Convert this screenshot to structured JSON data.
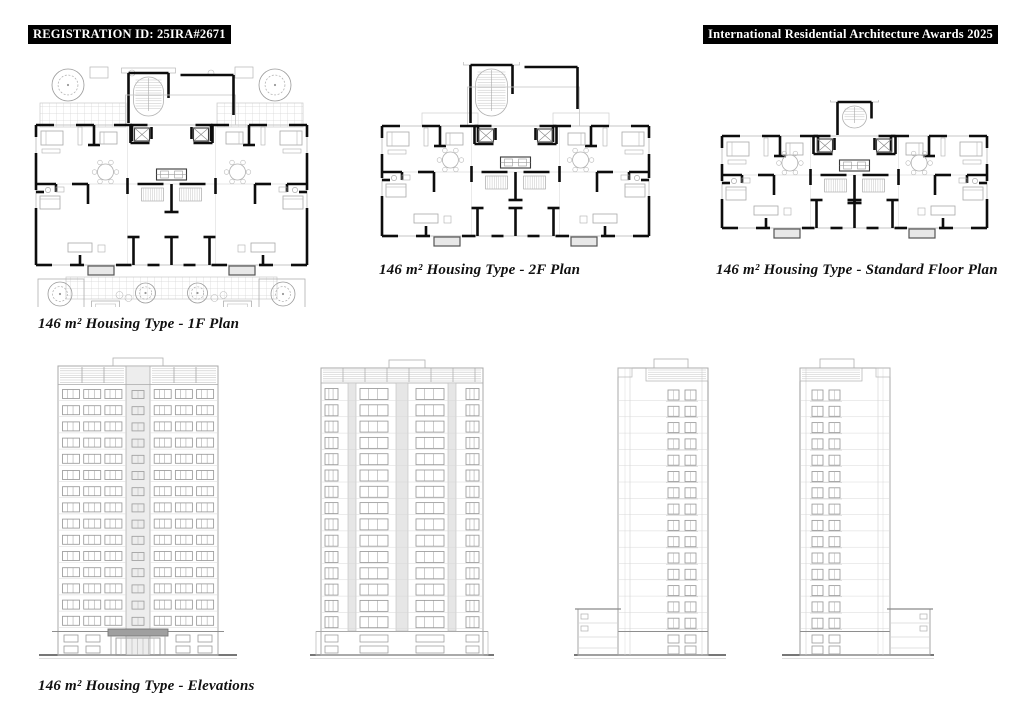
{
  "header": {
    "registration_badge": "REGISTRATION ID: 25IRA#2671",
    "awards_badge": "International Residential Architecture Awards 2025"
  },
  "labels": {
    "plan_1f": "146 m²  Housing Type - 1F Plan",
    "plan_2f": "146 m²  Housing Type - 2F Plan",
    "plan_std": "146 m²  Housing Type - Standard Floor Plan",
    "elevations": "146 m²  Housing Type - Elevations"
  },
  "drawings": {
    "plans": [
      {
        "id": "plan-1f",
        "variant": "1f"
      },
      {
        "id": "plan-2f",
        "variant": "2f"
      },
      {
        "id": "plan-std",
        "variant": "std"
      }
    ],
    "elevations": [
      {
        "id": "elev-front",
        "variant": "front",
        "floors": 15
      },
      {
        "id": "elev-rear",
        "variant": "rear",
        "floors": 15
      },
      {
        "id": "elev-side-left",
        "variant": "side-left",
        "floors": 15
      },
      {
        "id": "elev-side-right",
        "variant": "side-right",
        "floors": 15
      }
    ]
  },
  "colors": {
    "badge_bg": "#000000",
    "badge_text": "#ffffff",
    "label_text": "#111111",
    "wall_black": "#0d0d0d",
    "line_light": "#b3b3b3",
    "line_faint": "#d6d6d6",
    "line_mid": "#9a9a9a",
    "ground_dark": "#4a4a4a",
    "panel_fill": "#ededed",
    "canopy_gray": "#9f9f9f",
    "paper": "#ffffff"
  }
}
